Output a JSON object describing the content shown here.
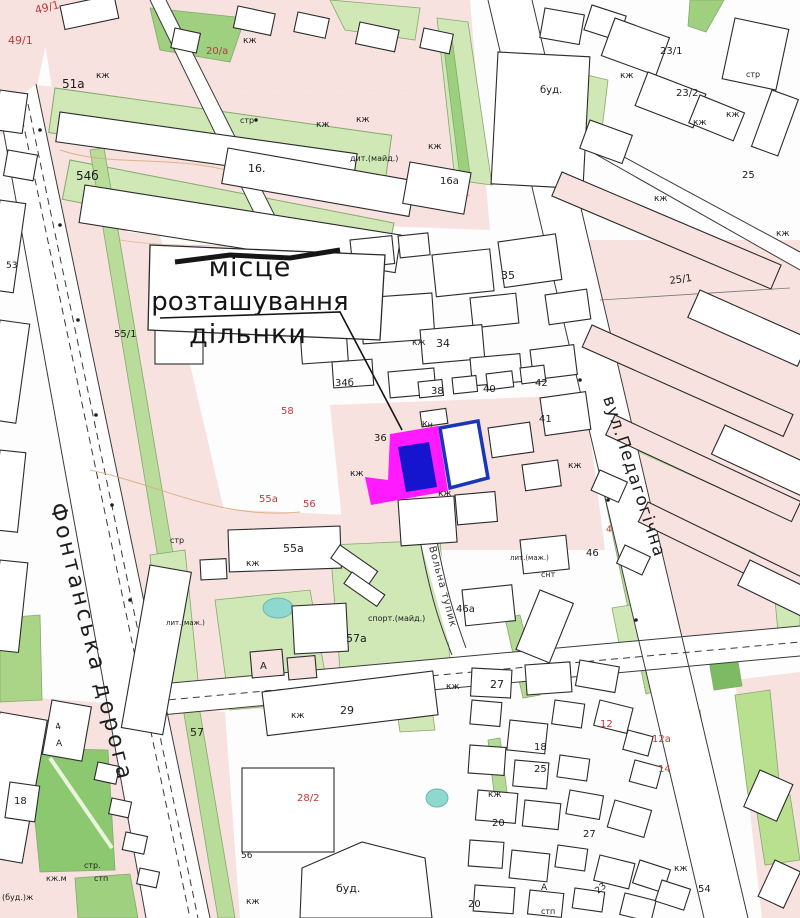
{
  "map": {
    "annotation": {
      "line1": "місце",
      "line2": "розташування",
      "line3": "дільнки"
    },
    "streets": [
      {
        "name": "Фонтанська дорога",
        "x": 50,
        "y": 505,
        "angle": 76,
        "size": 22,
        "spacing": 3.5,
        "color": "#1d1d1d"
      },
      {
        "name": "вул.Педагогічна",
        "x": 603,
        "y": 398,
        "angle": 72,
        "size": 17,
        "spacing": 1.5,
        "color": "#1d1d1d"
      },
      {
        "name": "Вольна тупик",
        "x": 429,
        "y": 547,
        "angle": 75,
        "size": 10,
        "spacing": 1,
        "color": "#333333"
      }
    ],
    "colors": {
      "parcel_outline": "#ff1aff",
      "parcel_fill": "#1515d0",
      "adjacent_parcel_outline": "#1736b8",
      "label_black": "#1c1c1c",
      "label_red": "#c03938",
      "block_pink": "#f7e2df",
      "green_light": "#cfe8b6",
      "green_dark": "#7cbb63",
      "pond_cyan": "#8fd8d0"
    },
    "labels": [
      {
        "t": "49/1",
        "x": 36,
        "y": 14,
        "c": "r",
        "s": 11,
        "r": -14
      },
      {
        "t": "49/1",
        "x": 8,
        "y": 44,
        "c": "r",
        "s": 11
      },
      {
        "t": "51а",
        "x": 62,
        "y": 88,
        "c": "k",
        "s": 12
      },
      {
        "t": "кж",
        "x": 96,
        "y": 78,
        "c": "k",
        "s": 9
      },
      {
        "t": "кж",
        "x": 243,
        "y": 43,
        "c": "k",
        "s": 9
      },
      {
        "t": "20/а",
        "x": 206,
        "y": 54,
        "c": "r",
        "s": 10
      },
      {
        "t": "стр",
        "x": 240,
        "y": 123,
        "c": "k",
        "s": 8
      },
      {
        "t": "54б",
        "x": 76,
        "y": 180,
        "c": "k",
        "s": 12
      },
      {
        "t": "16.",
        "x": 248,
        "y": 172,
        "c": "k",
        "s": 11
      },
      {
        "t": "кж",
        "x": 316,
        "y": 127,
        "c": "k",
        "s": 9
      },
      {
        "t": "кж",
        "x": 356,
        "y": 122,
        "c": "k",
        "s": 9
      },
      {
        "t": "дит.(майд.)",
        "x": 350,
        "y": 161,
        "c": "k",
        "s": 8
      },
      {
        "t": "кж",
        "x": 428,
        "y": 149,
        "c": "k",
        "s": 9
      },
      {
        "t": "16а",
        "x": 440,
        "y": 184,
        "c": "k",
        "s": 10
      },
      {
        "t": "буд.",
        "x": 540,
        "y": 93,
        "c": "k",
        "s": 10
      },
      {
        "t": "23/1",
        "x": 660,
        "y": 54,
        "c": "k",
        "s": 10
      },
      {
        "t": "23/2",
        "x": 676,
        "y": 96,
        "c": "k",
        "s": 10
      },
      {
        "t": "кж",
        "x": 620,
        "y": 78,
        "c": "k",
        "s": 9
      },
      {
        "t": "стр",
        "x": 746,
        "y": 77,
        "c": "k",
        "s": 8
      },
      {
        "t": "кж",
        "x": 726,
        "y": 117,
        "c": "k",
        "s": 9
      },
      {
        "t": "кж",
        "x": 693,
        "y": 125,
        "c": "k",
        "s": 9
      },
      {
        "t": "25",
        "x": 742,
        "y": 178,
        "c": "k",
        "s": 10
      },
      {
        "t": "кж",
        "x": 654,
        "y": 201,
        "c": "k",
        "s": 9
      },
      {
        "t": "25/1",
        "x": 670,
        "y": 284,
        "c": "k",
        "s": 10,
        "r": -8
      },
      {
        "t": "кж",
        "x": 776,
        "y": 236,
        "c": "k",
        "s": 9
      },
      {
        "t": "35",
        "x": 501,
        "y": 279,
        "c": "k",
        "s": 11
      },
      {
        "t": "кж",
        "x": 412,
        "y": 345,
        "c": "k",
        "s": 9
      },
      {
        "t": "34",
        "x": 436,
        "y": 347,
        "c": "k",
        "s": 11
      },
      {
        "t": "34б",
        "x": 335,
        "y": 386,
        "c": "k",
        "s": 10
      },
      {
        "t": "38",
        "x": 431,
        "y": 394,
        "c": "k",
        "s": 10
      },
      {
        "t": "40",
        "x": 483,
        "y": 392,
        "c": "k",
        "s": 10
      },
      {
        "t": "42",
        "x": 535,
        "y": 386,
        "c": "k",
        "s": 10
      },
      {
        "t": "36",
        "x": 374,
        "y": 441,
        "c": "k",
        "s": 10
      },
      {
        "t": "Кн",
        "x": 422,
        "y": 427,
        "c": "k",
        "s": 8
      },
      {
        "t": "41",
        "x": 539,
        "y": 422,
        "c": "k",
        "s": 10
      },
      {
        "t": "кж",
        "x": 350,
        "y": 476,
        "c": "k",
        "s": 9
      },
      {
        "t": "кж",
        "x": 438,
        "y": 496,
        "c": "k",
        "s": 9
      },
      {
        "t": "кж",
        "x": 568,
        "y": 468,
        "c": "k",
        "s": 9
      },
      {
        "t": "58",
        "x": 281,
        "y": 414,
        "c": "r",
        "s": 10
      },
      {
        "t": "55а",
        "x": 259,
        "y": 502,
        "c": "r",
        "s": 10
      },
      {
        "t": "56",
        "x": 303,
        "y": 507,
        "c": "r",
        "s": 10
      },
      {
        "t": "55/1",
        "x": 114,
        "y": 337,
        "c": "k",
        "s": 10
      },
      {
        "t": "53",
        "x": 6,
        "y": 268,
        "c": "k",
        "s": 9
      },
      {
        "t": "стр",
        "x": 170,
        "y": 543,
        "c": "k",
        "s": 8
      },
      {
        "t": "55а",
        "x": 283,
        "y": 552,
        "c": "k",
        "s": 11
      },
      {
        "t": "кж",
        "x": 246,
        "y": 566,
        "c": "k",
        "s": 9
      },
      {
        "t": "спорт.(майд.)",
        "x": 368,
        "y": 621,
        "c": "k",
        "s": 8
      },
      {
        "t": "лит.(маж.)",
        "x": 166,
        "y": 625,
        "c": "k",
        "s": 7
      },
      {
        "t": "46а",
        "x": 456,
        "y": 612,
        "c": "k",
        "s": 10
      },
      {
        "t": "46",
        "x": 586,
        "y": 556,
        "c": "k",
        "s": 10
      },
      {
        "t": "лит.(маж.)",
        "x": 510,
        "y": 560,
        "c": "k",
        "s": 7
      },
      {
        "t": "снт",
        "x": 541,
        "y": 577,
        "c": "k",
        "s": 8
      },
      {
        "t": "57а",
        "x": 346,
        "y": 642,
        "c": "k",
        "s": 11
      },
      {
        "t": "А",
        "x": 260,
        "y": 669,
        "c": "k",
        "s": 10
      },
      {
        "t": "А",
        "x": 56,
        "y": 746,
        "c": "k",
        "s": 9
      },
      {
        "t": "4",
        "x": 56,
        "y": 730,
        "c": "k",
        "s": 9,
        "r": -14
      },
      {
        "t": "4",
        "x": 606,
        "y": 532,
        "c": "r",
        "s": 9
      },
      {
        "t": "29",
        "x": 340,
        "y": 714,
        "c": "k",
        "s": 11
      },
      {
        "t": "кж",
        "x": 291,
        "y": 718,
        "c": "k",
        "s": 9
      },
      {
        "t": "57",
        "x": 190,
        "y": 736,
        "c": "k",
        "s": 11
      },
      {
        "t": "27",
        "x": 490,
        "y": 688,
        "c": "k",
        "s": 11
      },
      {
        "t": "кж",
        "x": 446,
        "y": 689,
        "c": "k",
        "s": 9
      },
      {
        "t": "28/2",
        "x": 297,
        "y": 801,
        "c": "r",
        "s": 10
      },
      {
        "t": "56",
        "x": 241,
        "y": 858,
        "c": "k",
        "s": 9
      },
      {
        "t": "кж",
        "x": 246,
        "y": 904,
        "c": "k",
        "s": 9
      },
      {
        "t": "буд.",
        "x": 336,
        "y": 892,
        "c": "k",
        "s": 11
      },
      {
        "t": "18",
        "x": 14,
        "y": 804,
        "c": "k",
        "s": 10
      },
      {
        "t": "стр.",
        "x": 84,
        "y": 868,
        "c": "k",
        "s": 8
      },
      {
        "t": "кж.м",
        "x": 46,
        "y": 881,
        "c": "k",
        "s": 8
      },
      {
        "t": "стп",
        "x": 94,
        "y": 881,
        "c": "k",
        "s": 8
      },
      {
        "t": "(буд.)ж",
        "x": 2,
        "y": 900,
        "c": "k",
        "s": 8
      },
      {
        "t": "12",
        "x": 600,
        "y": 727,
        "c": "r",
        "s": 10
      },
      {
        "t": "12а",
        "x": 652,
        "y": 742,
        "c": "r",
        "s": 10
      },
      {
        "t": "14",
        "x": 658,
        "y": 772,
        "c": "r",
        "s": 10
      },
      {
        "t": "18",
        "x": 534,
        "y": 750,
        "c": "k",
        "s": 10
      },
      {
        "t": "25",
        "x": 534,
        "y": 772,
        "c": "k",
        "s": 10
      },
      {
        "t": "кж",
        "x": 488,
        "y": 797,
        "c": "k",
        "s": 9
      },
      {
        "t": "20",
        "x": 492,
        "y": 826,
        "c": "k",
        "s": 10
      },
      {
        "t": "20",
        "x": 468,
        "y": 907,
        "c": "k",
        "s": 10
      },
      {
        "t": "27",
        "x": 583,
        "y": 837,
        "c": "k",
        "s": 10
      },
      {
        "t": "23",
        "x": 598,
        "y": 894,
        "c": "k",
        "s": 9,
        "r": -40
      },
      {
        "t": "кж",
        "x": 674,
        "y": 871,
        "c": "k",
        "s": 9
      },
      {
        "t": "54",
        "x": 698,
        "y": 892,
        "c": "k",
        "s": 10
      },
      {
        "t": "А",
        "x": 541,
        "y": 890,
        "c": "k",
        "s": 9
      },
      {
        "t": "стп",
        "x": 541,
        "y": 914,
        "c": "k",
        "s": 8
      }
    ]
  }
}
